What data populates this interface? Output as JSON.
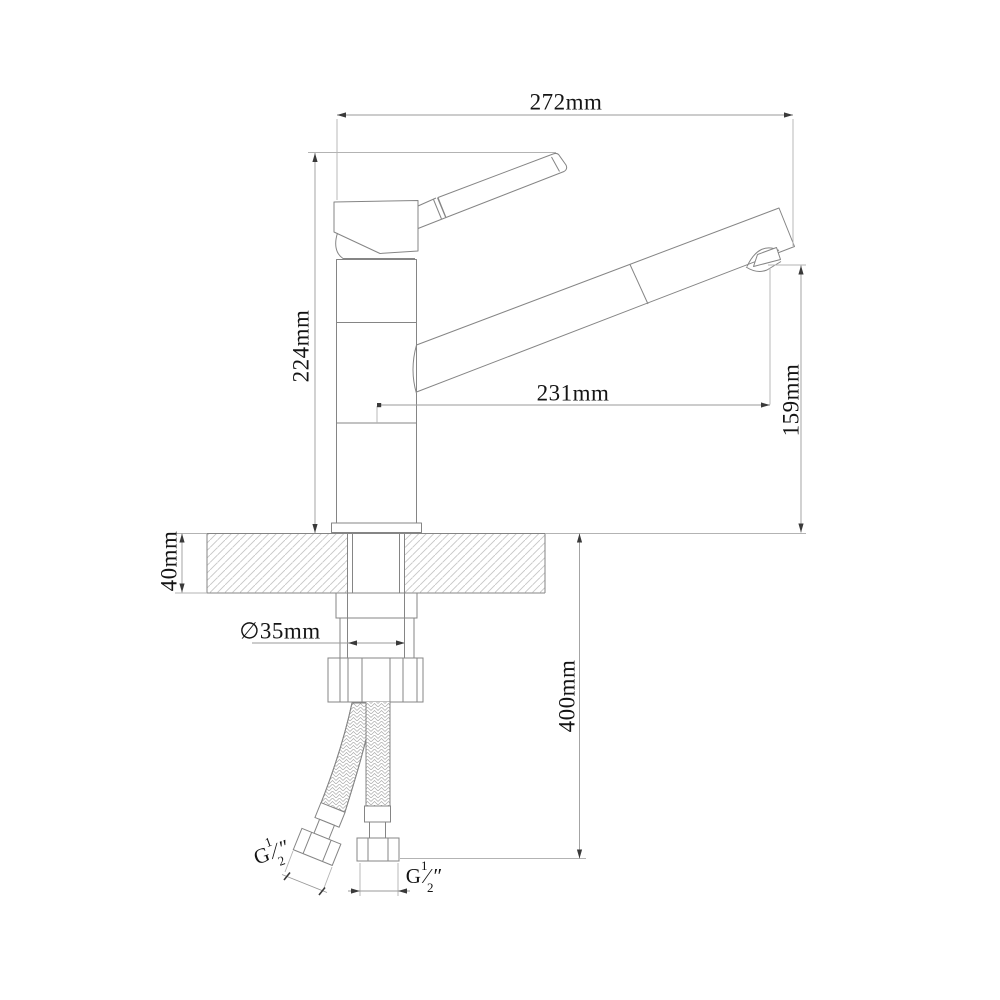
{
  "diagram": {
    "type": "technical-dimension-drawing",
    "subject": "single-lever kitchen sink mixer faucet, side elevation with installation dimensions",
    "background_color": "#ffffff",
    "colors": {
      "geometry_line": "#858585",
      "dimension_line": "#9a9a9a",
      "extension_line": "#b3b3b3",
      "arrow": "#3a3a3a",
      "hatch": "#c6c6c6",
      "text": "#141414"
    },
    "labels": {
      "overall_width": "272mm",
      "height_above_deck": "224mm",
      "spout_reach": "231mm",
      "spout_outlet_height": "159mm",
      "deck_thickness": "40mm",
      "mounting_hole_diameter": "∅35mm",
      "hose_drop_length": "400mm",
      "thread_left": {
        "prefix": "G",
        "numerator": "1",
        "slash": "⁄",
        "denominator": "2",
        "unit": "″"
      },
      "thread_right": {
        "prefix": "G",
        "numerator": "1",
        "slash": "⁄",
        "denominator": "2",
        "unit": "″"
      }
    }
  }
}
